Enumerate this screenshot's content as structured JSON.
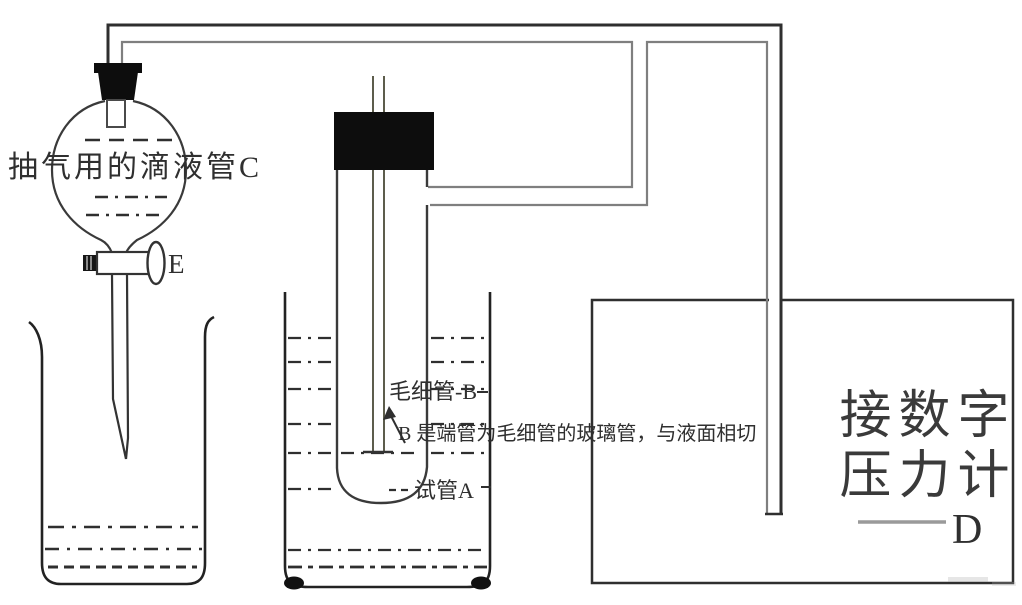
{
  "diagram": {
    "funnel": {
      "label": "抽气用的滴液管C",
      "stopcock_label": "E"
    },
    "test_tube": {
      "capillary_label": "毛细管-B",
      "note": "B 是端管为毛细管的玻璃管，与液面相切",
      "label": "试管A"
    },
    "gauge": {
      "line1": "接数字",
      "line2": "压力计",
      "connector_label": "D"
    }
  },
  "colors": {
    "ink": "#2f2f2f",
    "tube_gray": "#7f7f7f",
    "stopper": "#0d0d0d",
    "gauge_text": "#3a3a3a",
    "background": "#ffffff"
  }
}
